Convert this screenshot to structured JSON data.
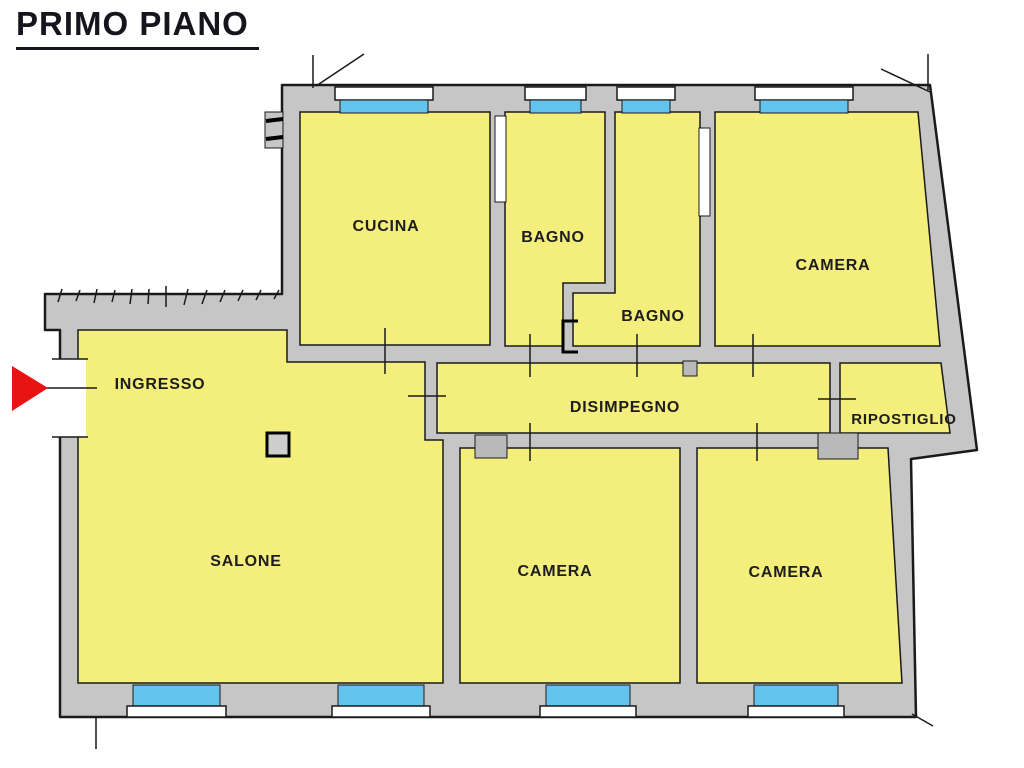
{
  "title": {
    "text": "PRIMO PIANO"
  },
  "floor_plan": {
    "rooms": [
      {
        "id": "ingresso",
        "label": "INGRESSO"
      },
      {
        "id": "cucina",
        "label": "CUCINA"
      },
      {
        "id": "bagno-1",
        "label": "BAGNO"
      },
      {
        "id": "bagno-2",
        "label": "BAGNO"
      },
      {
        "id": "camera-nord",
        "label": "CAMERA"
      },
      {
        "id": "disimpegno",
        "label": "DISIMPEGNO"
      },
      {
        "id": "ripostiglio",
        "label": "RIPOSTIGLIO"
      },
      {
        "id": "salone",
        "label": "SALONE"
      },
      {
        "id": "camera-centrale",
        "label": "CAMERA"
      },
      {
        "id": "camera-sud",
        "label": "CAMERA"
      }
    ],
    "colors": {
      "room_fill": "#F4EE7D",
      "window_glass": "#62C3EC",
      "wall_fill": "#C6C6C6",
      "outline": "#1A1A1A",
      "entrance_arrow": "#E81313"
    }
  }
}
